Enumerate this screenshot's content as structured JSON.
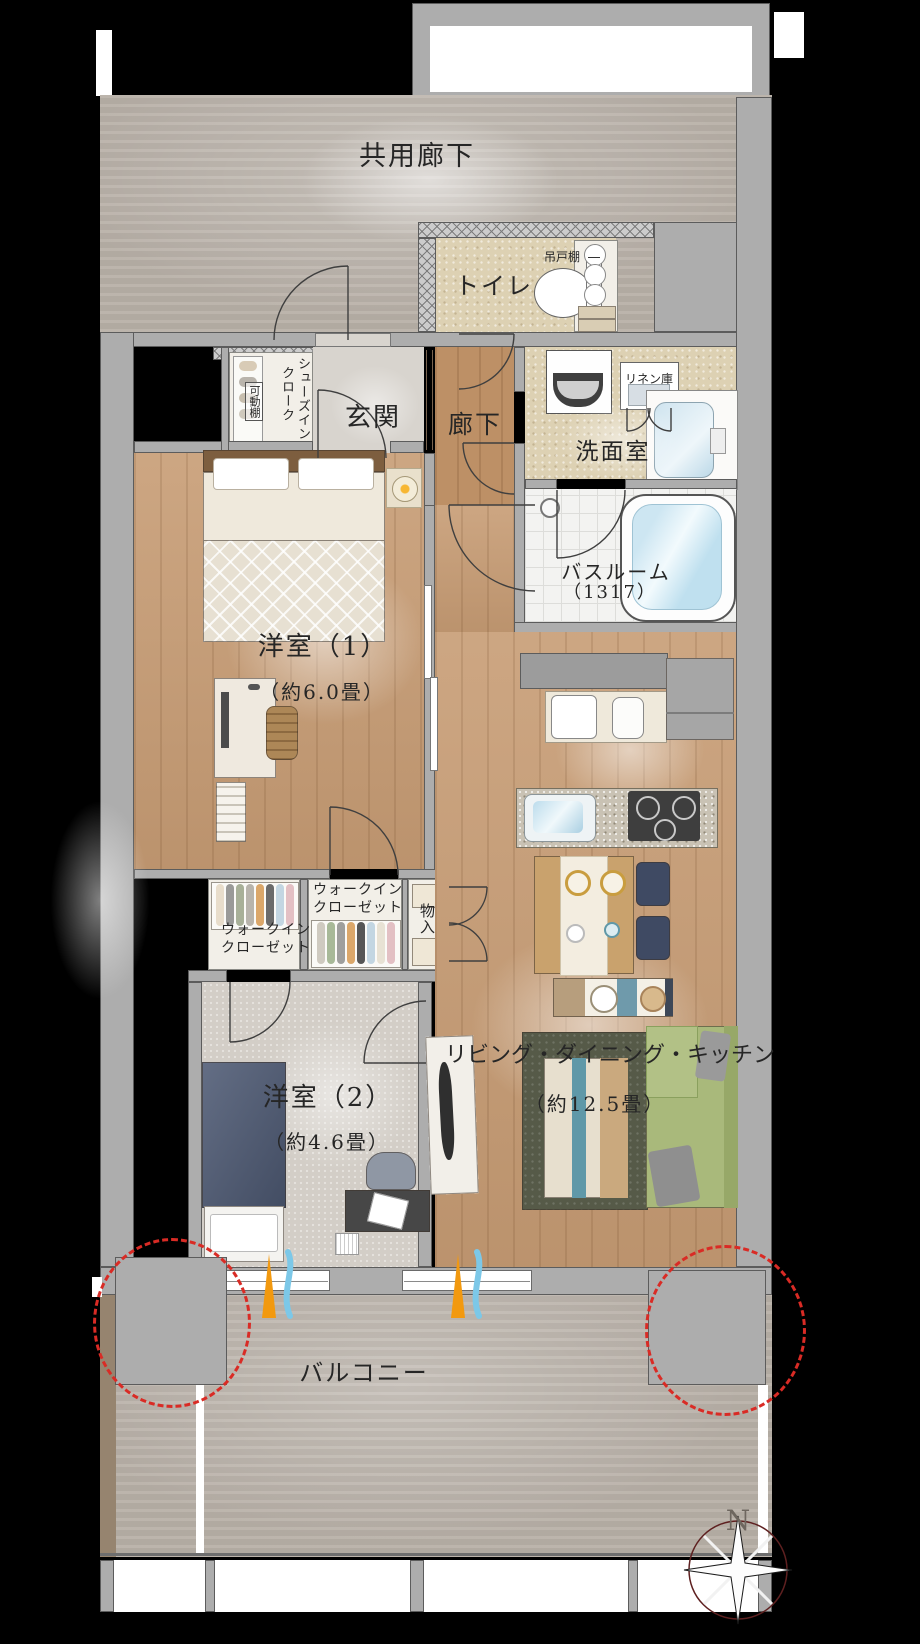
{
  "plan": {
    "common_corridor": "共用廊下",
    "toilet": "トイレ",
    "hanging_cupboard": "吊戸棚",
    "entrance": "玄関",
    "shoes_closet_l1": "シューズイン",
    "shoes_closet_l2": "クローク",
    "movable_shelf": "可動棚",
    "hallway": "廊下",
    "linen_closet": "リネン庫",
    "washroom": "洗面室",
    "bathroom": "バスルーム",
    "bathroom_size": "（1317）",
    "room1": "洋室（1）",
    "room1_size": "（約6.0畳）",
    "wic1_l1": "ウォークイン",
    "wic1_l2": "クローゼット",
    "wic2_l1": "ウォークイン",
    "wic2_l2": "クローゼット",
    "storage": "物入",
    "room2": "洋室（2）",
    "room2_size": "（約4.6畳）",
    "ldk": "リビング・ダイニング・キッチン",
    "ldk_size": "（約12.5畳）",
    "balcony": "バルコニー",
    "north": "N"
  },
  "colors": {
    "background": "#000000",
    "wall_gray": "#adadad",
    "wood_floor": "#c79c74",
    "concrete_floor": "#b7afa6",
    "wet_area_floor": "#ddd1b3",
    "pillar_dashed_red": "#d92b25",
    "airflow_orange": "#f2990f",
    "airflow_blue": "#7cc8e8",
    "bed_navy": "#4e5a74",
    "sofa_green": "#a9b97b",
    "compass_circle": "#5e2020"
  }
}
